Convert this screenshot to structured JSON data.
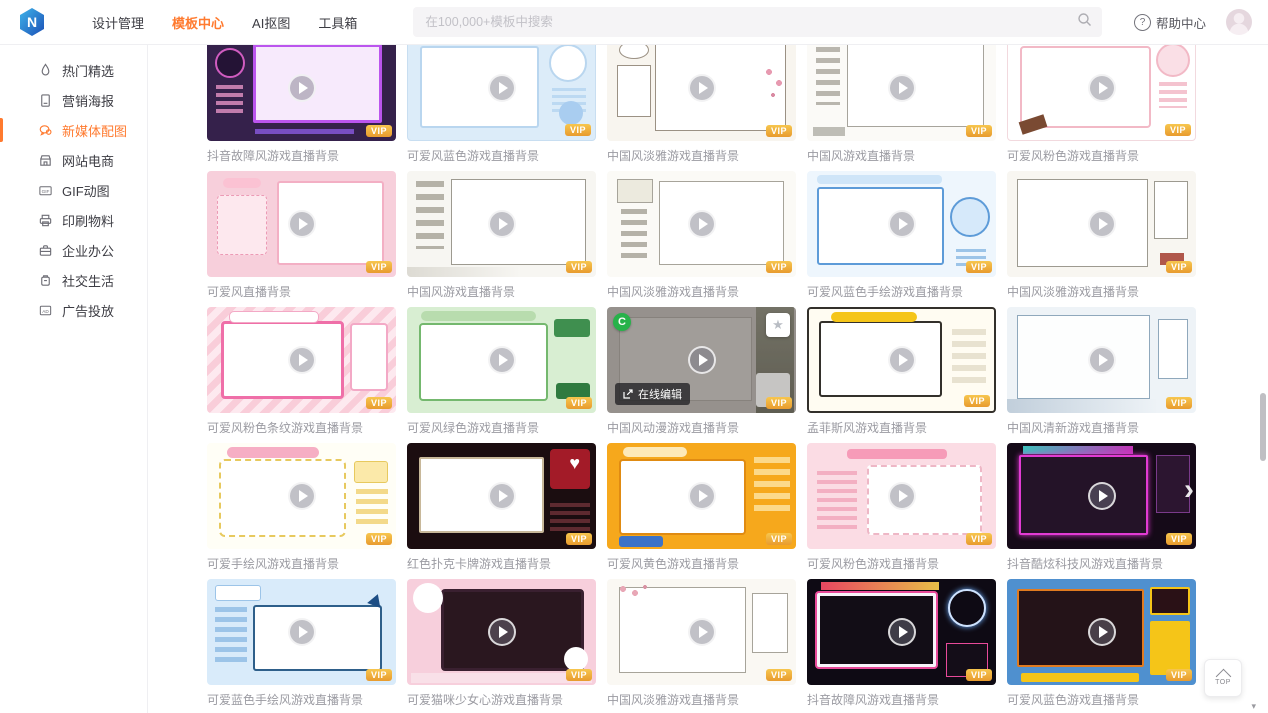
{
  "navbar": {
    "logo_text": "N",
    "items": [
      {
        "label": "设计管理",
        "active": false
      },
      {
        "label": "模板中心",
        "active": true
      },
      {
        "label": "AI抠图",
        "active": false
      },
      {
        "label": "工具箱",
        "active": false
      }
    ],
    "search_placeholder": "在100,000+模板中搜索",
    "help_label": "帮助中心"
  },
  "sidebar": {
    "items": [
      {
        "label": "热门精选",
        "icon": "flame-icon",
        "active": false
      },
      {
        "label": "营销海报",
        "icon": "poster-icon",
        "active": false
      },
      {
        "label": "新媒体配图",
        "icon": "chat-image-icon",
        "active": true
      },
      {
        "label": "网站电商",
        "icon": "storefront-icon",
        "active": false
      },
      {
        "label": "GIF动图",
        "icon": "gif-icon",
        "active": false
      },
      {
        "label": "印刷物料",
        "icon": "printer-icon",
        "active": false
      },
      {
        "label": "企业办公",
        "icon": "briefcase-icon",
        "active": false
      },
      {
        "label": "社交生活",
        "icon": "social-icon",
        "active": false
      },
      {
        "label": "广告投放",
        "icon": "ad-icon",
        "active": false
      }
    ]
  },
  "grid": {
    "cards": [
      {
        "title": "抖音故障风游戏直播背景",
        "vip": true
      },
      {
        "title": "可爱风蓝色游戏直播背景",
        "vip": true
      },
      {
        "title": "中国风淡雅游戏直播背景",
        "vip": true
      },
      {
        "title": "中国风游戏直播背景",
        "vip": true
      },
      {
        "title": "可爱风粉色游戏直播背景",
        "vip": true
      },
      {
        "title": "可爱风直播背景",
        "vip": true
      },
      {
        "title": "中国风游戏直播背景",
        "vip": true
      },
      {
        "title": "中国风淡雅游戏直播背景",
        "vip": true
      },
      {
        "title": "可爱风蓝色手绘游戏直播背景",
        "vip": true
      },
      {
        "title": "中国风淡雅游戏直播背景",
        "vip": true
      },
      {
        "title": "可爱风粉色条纹游戏直播背景",
        "vip": true
      },
      {
        "title": "可爱风绿色游戏直播背景",
        "vip": true
      },
      {
        "title": "中国风动漫游戏直播背景",
        "vip": true,
        "hovered": true
      },
      {
        "title": "孟菲斯风游戏直播背景",
        "vip": true
      },
      {
        "title": "中国风清新游戏直播背景",
        "vip": true
      },
      {
        "title": "可爱手绘风游戏直播背景",
        "vip": true
      },
      {
        "title": "红色扑克卡牌游戏直播背景",
        "vip": true
      },
      {
        "title": "可爱风黄色游戏直播背景",
        "vip": true
      },
      {
        "title": "可爱风粉色游戏直播背景",
        "vip": true
      },
      {
        "title": "抖音酷炫科技风游戏直播背景",
        "vip": true
      },
      {
        "title": "可爱蓝色手绘风游戏直播背景",
        "vip": true
      },
      {
        "title": "可爱猫咪少女心游戏直播背景",
        "vip": true
      },
      {
        "title": "中国风淡雅游戏直播背景",
        "vip": true
      },
      {
        "title": "抖音故障风游戏直播背景",
        "vip": true
      },
      {
        "title": "可爱风蓝色游戏直播背景",
        "vip": true
      }
    ]
  },
  "hover": {
    "edit_label": "在线编辑",
    "corner_badge": "C"
  },
  "misc": {
    "vip_label": "VIP",
    "back_to_top": "TOP"
  },
  "colors": {
    "accent_orange": "#ff7a2f",
    "vip_gold": "#eda23b",
    "logo_blue": "#2a6fd6",
    "hover_badge_green": "#27b24a"
  }
}
